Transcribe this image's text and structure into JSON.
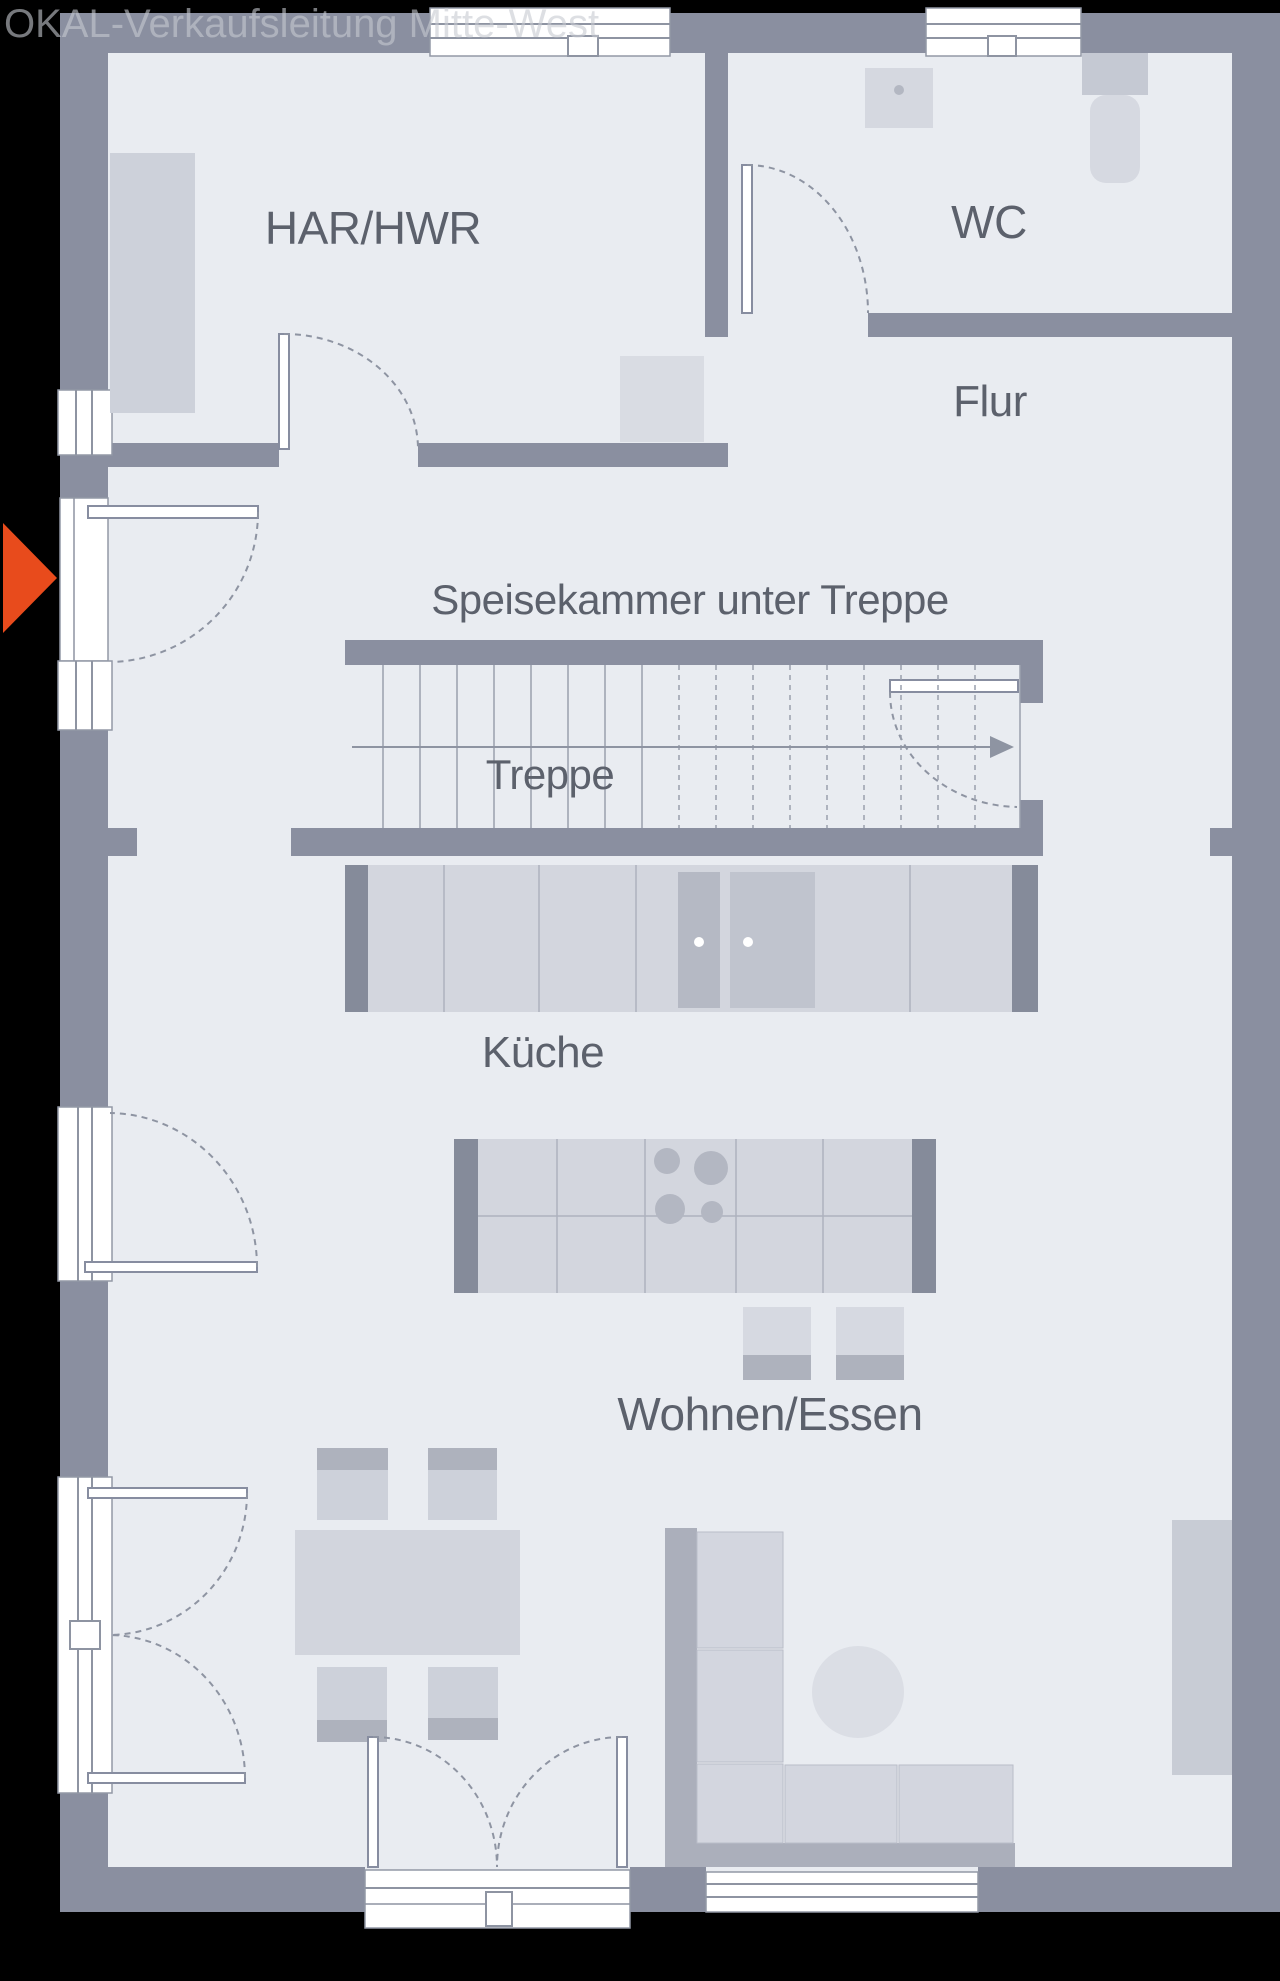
{
  "watermark": "OKAL-Verkaufsleitung Mitte-West",
  "rooms": [
    {
      "id": "har-hwr",
      "label": "HAR/HWR"
    },
    {
      "id": "wc",
      "label": "WC"
    },
    {
      "id": "flur",
      "label": "Flur"
    },
    {
      "id": "speisekammer",
      "label": "Speisekammer unter Treppe"
    },
    {
      "id": "treppe",
      "label": "Treppe"
    },
    {
      "id": "kueche",
      "label": "Küche"
    },
    {
      "id": "wohnen-essen",
      "label": "Wohnen/Essen"
    }
  ],
  "entrance_marker": {
    "shape": "triangle-right",
    "color": "#e84b1c"
  },
  "colors": {
    "background": "#000000",
    "wall": "#8a8fa0",
    "floor": "#e9ecf1",
    "furniture_light": "#d3d6de",
    "furniture_mid": "#c3c7d1",
    "furniture_dark": "#adb1bd",
    "line": "#8e94a2",
    "label_text": "#5c616c"
  }
}
